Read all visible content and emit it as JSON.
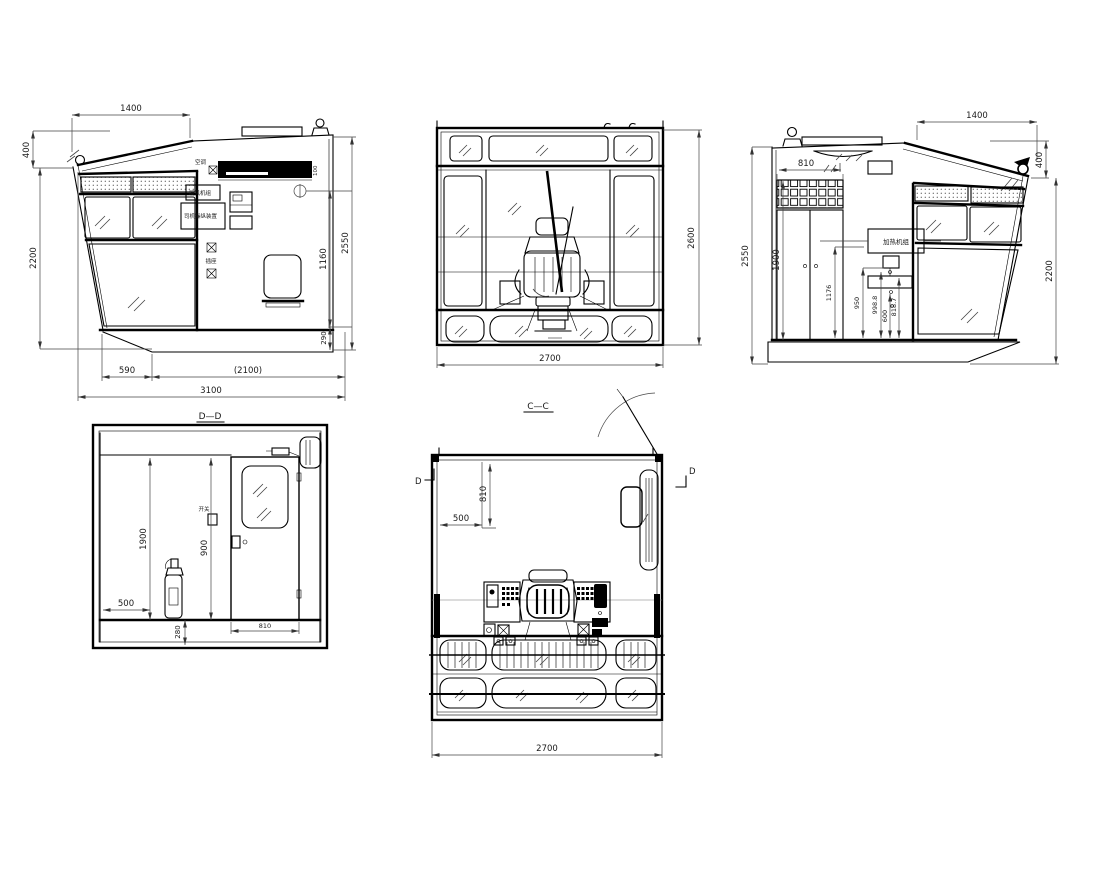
{
  "drawing": {
    "kind": "multi-view CAD drawing of a crane operator cabin",
    "line_color": "#000000",
    "dim_color": "#444444",
    "background": "#ffffff"
  },
  "views": {
    "v1": {
      "d1400": "1400",
      "d400": "400",
      "d2200": "2200",
      "d2550": "2550",
      "d1160": "1160",
      "d290": "290",
      "d590": "590",
      "d2100": "(2100)",
      "d3100": "3100",
      "d100": "100",
      "lbl_ac": "空调",
      "lbl_box1": "暖风机组",
      "lbl_box2": "司机操纵装置",
      "lbl_socket": "插座"
    },
    "v2": {
      "d2700": "2700",
      "d2600": "2600"
    },
    "v3": {
      "d1400": "1400",
      "d400": "400",
      "d2200": "2200",
      "d2550": "2550",
      "d1900": "1900",
      "d810": "810",
      "d1176": "1176",
      "d950": "950",
      "d998": "998.8",
      "d600": "600",
      "d818": "818.7",
      "lbl_unit": "加热机组"
    },
    "v4": {
      "title": "D—D",
      "d1900": "1900",
      "d900": "900",
      "d500": "500",
      "d280": "280",
      "d810": "810",
      "lbl_switch": "开关"
    },
    "v5": {
      "title": "C—C",
      "d500": "500",
      "d810": "810",
      "d2700": "2700",
      "marker_left": "D",
      "marker_right": "D"
    }
  }
}
